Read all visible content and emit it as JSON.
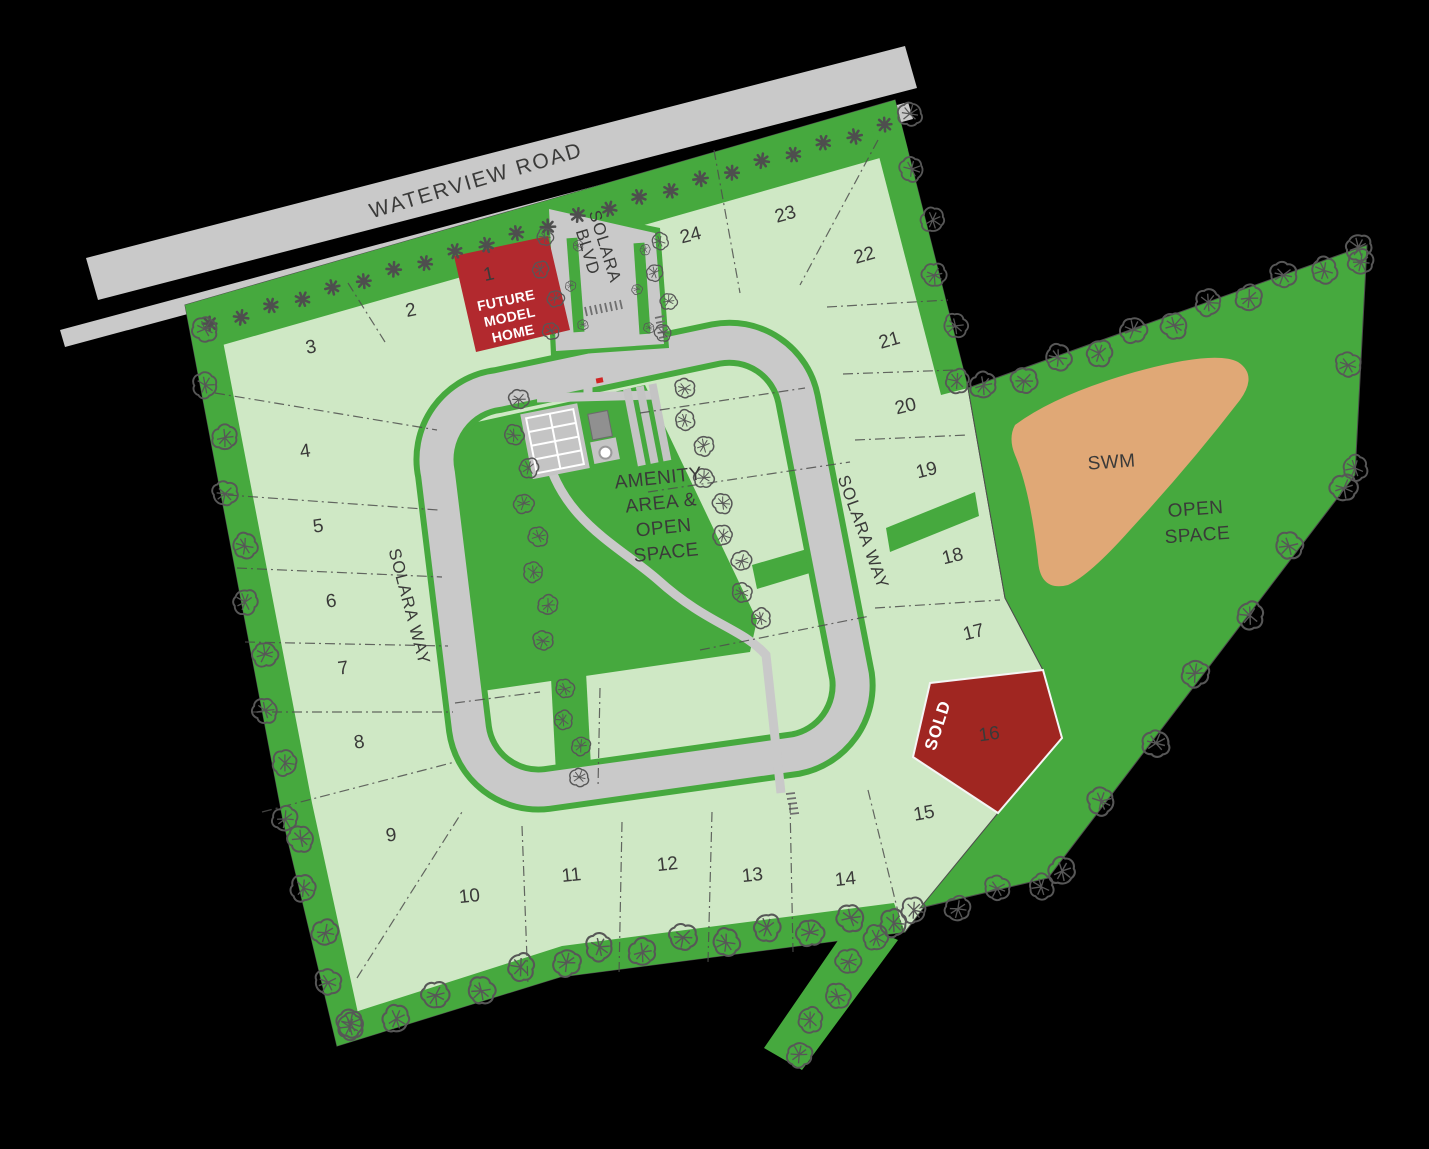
{
  "map": {
    "roads": {
      "waterview": "WATERVIEW ROAD",
      "blvd_line1": "SOLARA",
      "blvd_line2": "BLVD",
      "way_left": "SOLARA WAY",
      "way_right": "SOLARA WAY"
    },
    "areas": {
      "amenity_line1": "AMENITY",
      "amenity_line2": "AREA &",
      "amenity_line3": "OPEN",
      "amenity_line4": "SPACE",
      "swm": "SWM",
      "open_line1": "OPEN",
      "open_line2": "SPACE"
    },
    "special": {
      "sold": "SOLD",
      "model_line1": "FUTURE",
      "model_line2": "MODEL",
      "model_line3": "HOME"
    },
    "lots": [
      {
        "num": "1",
        "x": 490,
        "y": 280,
        "rot": -12,
        "status": "future-model-home"
      },
      {
        "num": "2",
        "x": 412,
        "y": 316,
        "rot": -12,
        "status": "available"
      },
      {
        "num": "3",
        "x": 312,
        "y": 353,
        "rot": -10,
        "status": "available"
      },
      {
        "num": "4",
        "x": 306,
        "y": 457,
        "rot": -8,
        "status": "available"
      },
      {
        "num": "5",
        "x": 319,
        "y": 532,
        "rot": -8,
        "status": "available"
      },
      {
        "num": "6",
        "x": 332,
        "y": 607,
        "rot": -8,
        "status": "available"
      },
      {
        "num": "7",
        "x": 344,
        "y": 674,
        "rot": -8,
        "status": "available"
      },
      {
        "num": "8",
        "x": 360,
        "y": 748,
        "rot": -8,
        "status": "available"
      },
      {
        "num": "9",
        "x": 392,
        "y": 841,
        "rot": -8,
        "status": "available"
      },
      {
        "num": "10",
        "x": 470,
        "y": 902,
        "rot": -6,
        "status": "available"
      },
      {
        "num": "11",
        "x": 572,
        "y": 881,
        "rot": -6,
        "status": "available"
      },
      {
        "num": "12",
        "x": 668,
        "y": 870,
        "rot": -6,
        "status": "available"
      },
      {
        "num": "13",
        "x": 753,
        "y": 881,
        "rot": -6,
        "status": "available"
      },
      {
        "num": "14",
        "x": 846,
        "y": 885,
        "rot": -6,
        "status": "available"
      },
      {
        "num": "15",
        "x": 925,
        "y": 819,
        "rot": -10,
        "status": "available"
      },
      {
        "num": "16",
        "x": 990,
        "y": 740,
        "rot": -8,
        "status": "sold"
      },
      {
        "num": "17",
        "x": 975,
        "y": 638,
        "rot": -14,
        "status": "available"
      },
      {
        "num": "18",
        "x": 954,
        "y": 562,
        "rot": -14,
        "status": "available"
      },
      {
        "num": "19",
        "x": 928,
        "y": 476,
        "rot": -14,
        "status": "available"
      },
      {
        "num": "20",
        "x": 907,
        "y": 412,
        "rot": -14,
        "status": "available"
      },
      {
        "num": "21",
        "x": 891,
        "y": 346,
        "rot": -16,
        "status": "available"
      },
      {
        "num": "22",
        "x": 866,
        "y": 261,
        "rot": -16,
        "status": "available"
      },
      {
        "num": "23",
        "x": 787,
        "y": 220,
        "rot": -16,
        "status": "available"
      },
      {
        "num": "24",
        "x": 692,
        "y": 241,
        "rot": -14,
        "status": "available"
      }
    ],
    "colors": {
      "lot_available": "#cfe8c5",
      "open_green": "#46a93e",
      "road_gray": "#c9c9c9",
      "model_home_red": "#b2292e",
      "sold_red": "#a02621",
      "swm_tan": "#e0a876",
      "tree_gray": "#575757"
    }
  }
}
